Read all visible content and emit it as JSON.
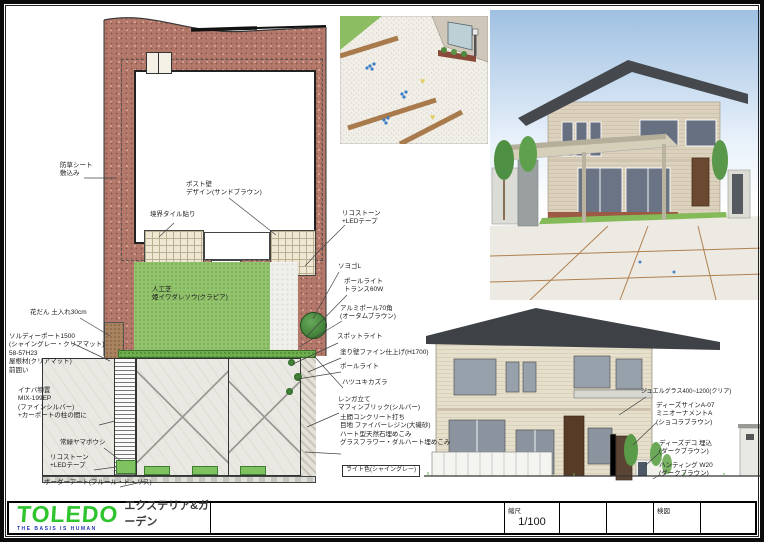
{
  "title_block": {
    "logo": "TOLEDO",
    "tagline": "THE BASIS IS HUMAN",
    "department": "エクステリア&ガーデン",
    "scale_label": "縮尺",
    "scale_value": "1/100",
    "check_label": "検図"
  },
  "plan": {
    "lawn_label": "人工芝\n姫イワダレソウ(クラピア)",
    "labels": [
      {
        "text": "防草シート\n敷込み"
      },
      {
        "text": "ポスト壁\nデザイン(サンドブラウン)"
      },
      {
        "text": "境界タイル貼り"
      },
      {
        "text": "リコストーン\n+LEDテープ"
      },
      {
        "text": "ソヨゴL"
      },
      {
        "text": "ポールライト\nトランス60W"
      },
      {
        "text": "アルミポール70角\n(オータムブラウン)"
      },
      {
        "text": "スポットライト"
      },
      {
        "text": "塗り壁ファイン仕上げ(H1700)"
      },
      {
        "text": "ポールライト"
      },
      {
        "text": "ハツユキカズラ"
      },
      {
        "text": "レンガ立て\nマフィンブリック(シルバー)"
      },
      {
        "text": "土間コンクリート打ち\n目地 ファイバーレジン(大磯砂)\nハート型天然石埋めこみ\nグラスフラワー・ダルハート埋めこみ"
      },
      {
        "text": "ライト色(シャイングレー)"
      },
      {
        "text": "花だん 土入れ30cm"
      },
      {
        "text": "ソルディーポート1500\n(シャイングレー・クリアマット)\n58-57H23\n屋根材(クリアマット)\n前囲い"
      },
      {
        "text": "イナバ物置\nMIX-199EP\n(ファインシルバー)\n+カーポートの柱の間に"
      },
      {
        "text": "常緑ヤマボウシ"
      },
      {
        "text": "リコストーン\n+LEDテープ"
      },
      {
        "text": "ボーダーアート(フルール・ド・リス)"
      }
    ]
  },
  "elevation": {
    "labels": [
      {
        "text": "ジュエルグラス400~1200(クリア)"
      },
      {
        "text": "ディーズサインA-07\nミニオーナメントA\n(ショコラブラウン)"
      },
      {
        "text": "ディーズデコ 埋込\n(ダークブラウン)"
      },
      {
        "text": "ハンティング W20\n(ダークブラウン)"
      }
    ]
  },
  "colors": {
    "gravel": "#b5796c",
    "lawn": "#92c36d",
    "concrete": "#e9e8e2",
    "roof": "#45494e",
    "wall": "#dbd1bd",
    "sky": "#9fc0e2",
    "logo_green": "#2ec42e"
  }
}
